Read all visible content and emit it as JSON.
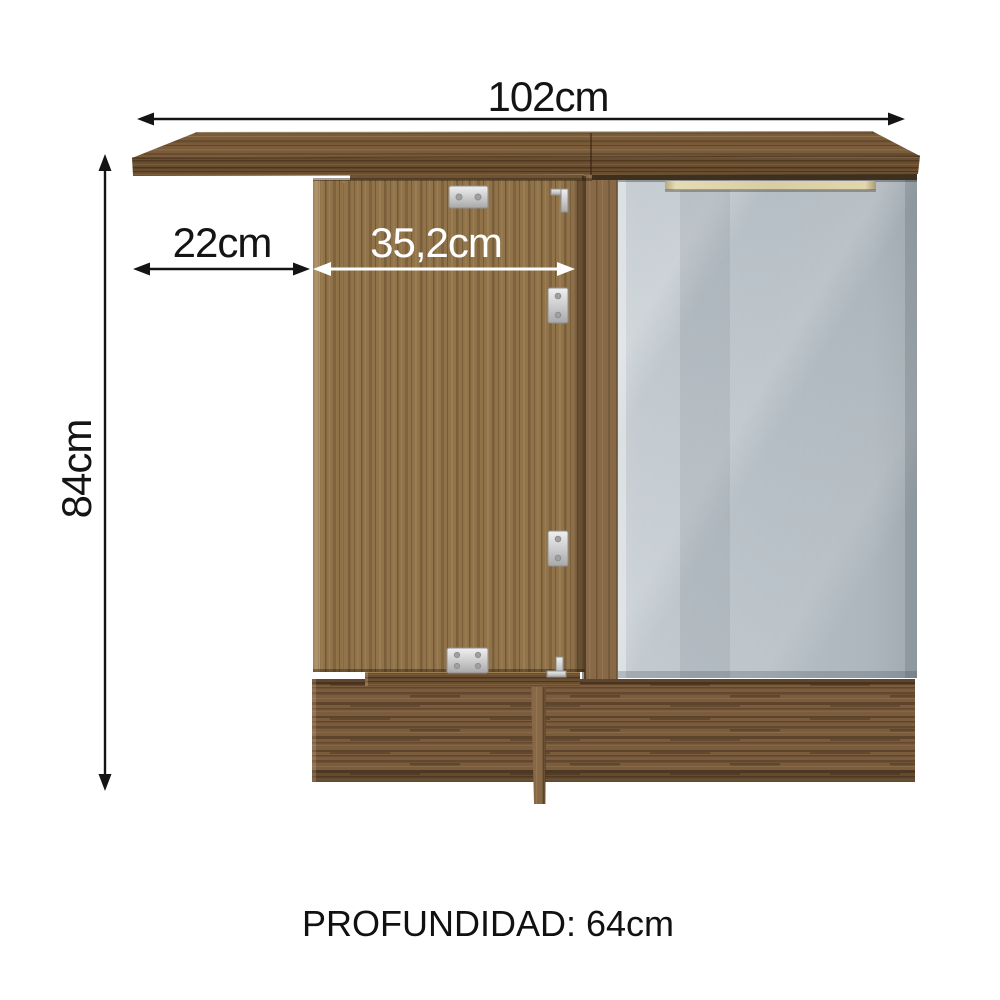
{
  "page": {
    "background": "#ffffff"
  },
  "diagram": {
    "caption": "PROFUNDIDAD: 64cm",
    "dimensions": {
      "total_width": "102cm",
      "left_overhang_width": "22cm",
      "open_door_width": "35,2cm",
      "height": "84cm"
    },
    "colors": {
      "wood_mid": "#91734a",
      "wood_dark": "#6a4e30",
      "wood_base": "#7b5c3d",
      "door_gray": "#b6bfc5",
      "handle_gold": "#d8cda4",
      "hinge_metal": "#d9d9d9",
      "annotation_black": "#141414",
      "annotation_white": "#ffffff"
    }
  }
}
